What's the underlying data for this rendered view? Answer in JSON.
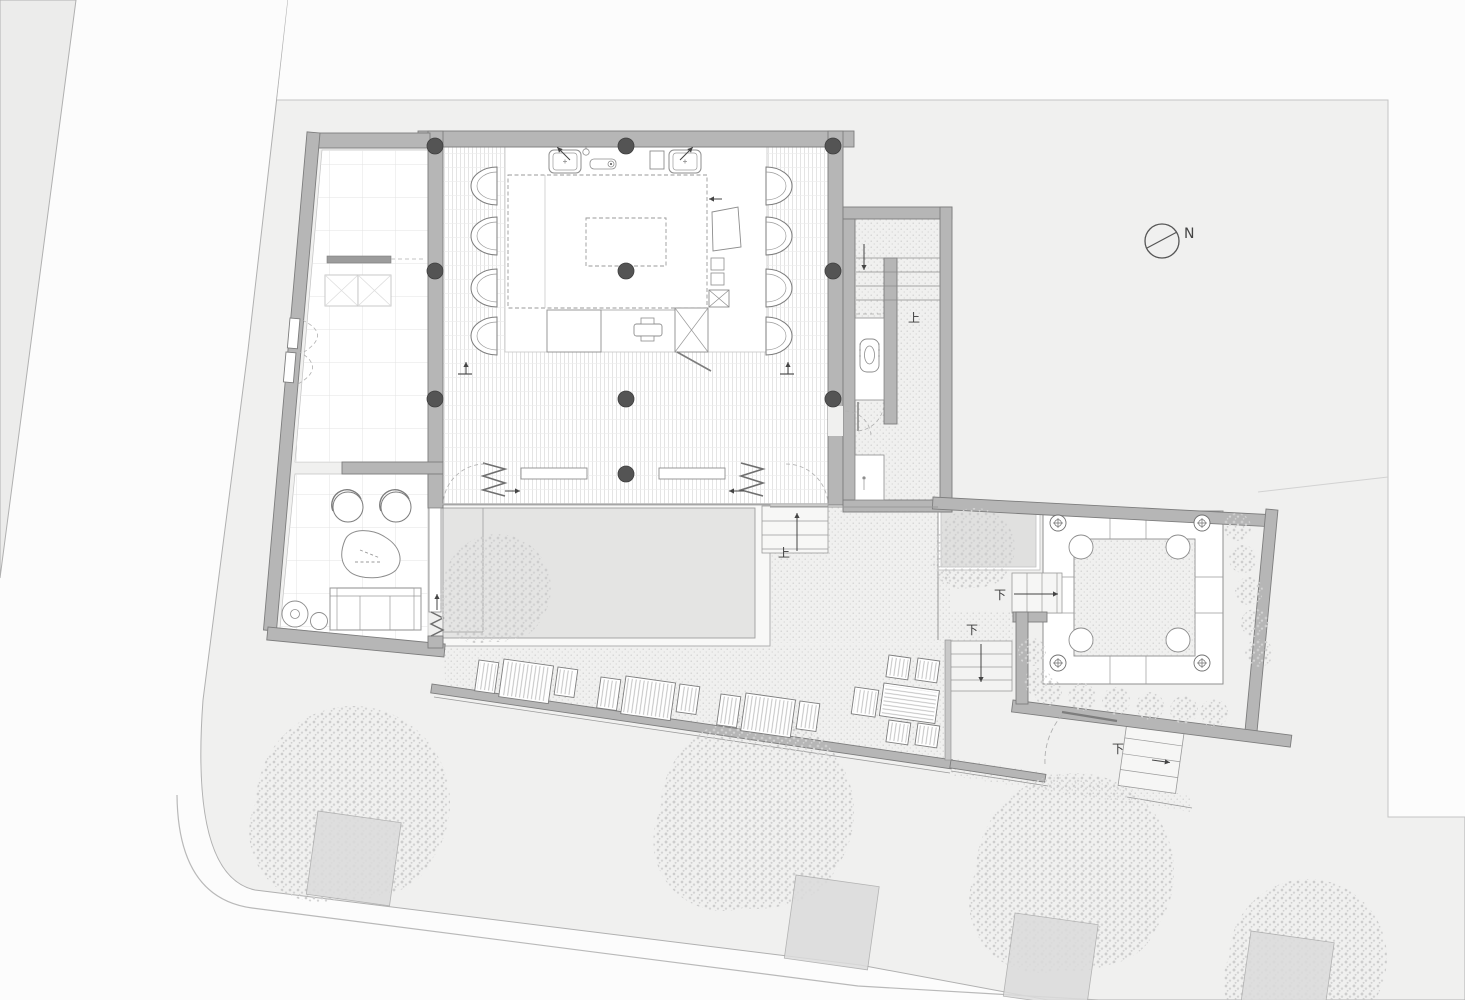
{
  "drawing": {
    "type": "architectural-floor-plan",
    "annotations": {
      "north": "N",
      "up_wing_stair": "上",
      "up_terrace_stair": "上",
      "down_courtyard_steps": "下",
      "down_terrace_stair": "下",
      "down_gate_stair": "下"
    },
    "colors": {
      "paper": "#fcfcfc",
      "site": "#f0f0ef",
      "neighbor": "#ececeb",
      "wall": "#b6b6b6",
      "wall_edge": "#7d7d7d",
      "boundary_line": "#b0b0b0",
      "water": "#e4e4e3",
      "deck": "#f8f8f7",
      "room": "#ffffff",
      "column": "#545454",
      "sand_dot": "#c2c2c2",
      "tree_dot": "#cdcdcd",
      "planter": "#dcdcdc"
    },
    "plan": {
      "columns": [
        [
          435,
          146
        ],
        [
          626,
          146
        ],
        [
          833,
          146
        ],
        [
          435,
          271
        ],
        [
          626,
          271
        ],
        [
          833,
          271
        ],
        [
          435,
          399
        ],
        [
          626,
          399
        ],
        [
          833,
          399
        ],
        [
          626,
          474
        ]
      ],
      "hall_chairs_left": {
        "x": 471,
        "tops": [
          167,
          217,
          269,
          317
        ]
      },
      "hall_chairs_right": {
        "x": 766,
        "tops": [
          167,
          217,
          269,
          317
        ]
      },
      "trees": [
        {
          "x": 497,
          "y": 588,
          "r": 54
        },
        {
          "x": 975,
          "y": 548,
          "r": 40
        },
        {
          "x": 353,
          "y": 803,
          "r": 97
        },
        {
          "x": 757,
          "y": 812,
          "r": 97
        },
        {
          "x": 1075,
          "y": 872,
          "r": 99
        },
        {
          "x": 1308,
          "y": 958,
          "r": 79
        }
      ],
      "bushes": [
        [
          1237,
          527
        ],
        [
          1243,
          559
        ],
        [
          1249,
          591
        ],
        [
          1255,
          623
        ],
        [
          1259,
          653
        ],
        [
          1048,
          692
        ],
        [
          1082,
          697
        ],
        [
          1116,
          701
        ],
        [
          1150,
          706
        ],
        [
          1184,
          710
        ],
        [
          1214,
          713
        ],
        [
          1032,
          652
        ],
        [
          1038,
          682
        ]
      ],
      "planter_beds": [
        {
          "x": 318,
          "y": 811
        },
        {
          "x": 796,
          "y": 875
        },
        {
          "x": 1015,
          "y": 913
        },
        {
          "x": 1251,
          "y": 931
        }
      ],
      "planter_bed_size": 84,
      "planter_bed_rot": 8,
      "round_tables": [
        [
          1081,
          547
        ],
        [
          1178,
          547
        ],
        [
          1081,
          640
        ],
        [
          1178,
          640
        ]
      ],
      "round_table_r": 12,
      "medallions": [
        [
          1058,
          523
        ],
        [
          1202,
          523
        ],
        [
          1058,
          663
        ],
        [
          1202,
          663
        ]
      ],
      "loungers": [
        {
          "x": 479,
          "y": 660,
          "w": 20,
          "h": 31
        },
        {
          "x": 504,
          "y": 659,
          "w": 50,
          "h": 38
        },
        {
          "x": 558,
          "y": 667,
          "w": 20,
          "h": 28
        },
        {
          "x": 601,
          "y": 677,
          "w": 20,
          "h": 31
        },
        {
          "x": 626,
          "y": 676,
          "w": 50,
          "h": 38
        },
        {
          "x": 680,
          "y": 684,
          "w": 20,
          "h": 28
        },
        {
          "x": 721,
          "y": 694,
          "w": 20,
          "h": 31
        },
        {
          "x": 746,
          "y": 693,
          "w": 50,
          "h": 38
        },
        {
          "x": 800,
          "y": 701,
          "w": 20,
          "h": 28
        },
        {
          "x": 889,
          "y": 655,
          "w": 22,
          "h": 22
        },
        {
          "x": 918,
          "y": 658,
          "w": 22,
          "h": 22
        },
        {
          "x": 889,
          "y": 720,
          "w": 22,
          "h": 22
        },
        {
          "x": 918,
          "y": 723,
          "w": 22,
          "h": 22
        },
        {
          "x": 855,
          "y": 687,
          "w": 24,
          "h": 27
        },
        {
          "x": 884,
          "y": 683,
          "w": 56,
          "h": 33,
          "horiz": true
        }
      ],
      "lounger_rot": 8,
      "swivel_chairs": [
        [
          348,
          507
        ],
        [
          396,
          507
        ]
      ],
      "side_tables": [
        {
          "x": 295,
          "y": 614,
          "r": 13,
          "inner": 4.5
        },
        {
          "x": 319,
          "y": 621,
          "r": 8.5
        }
      ],
      "arrows": [
        {
          "x": 505,
          "y": 491,
          "len": 15,
          "rot": 0
        },
        {
          "x": 744,
          "y": 491,
          "len": 15,
          "rot": 180
        },
        {
          "x": 437,
          "y": 610,
          "len": 16,
          "rot": -90
        },
        {
          "x": 864,
          "y": 244,
          "len": 26,
          "rot": 90
        },
        {
          "x": 1014,
          "y": 594,
          "len": 44,
          "rot": 0
        },
        {
          "x": 981,
          "y": 644,
          "len": 38,
          "rot": 90
        },
        {
          "x": 1152,
          "y": 760,
          "len": 18,
          "rot": 8
        },
        {
          "x": 722,
          "y": 199,
          "len": 13,
          "rot": 180
        },
        {
          "x": 466,
          "y": 374,
          "len": 12,
          "rot": -90
        },
        {
          "x": 788,
          "y": 374,
          "len": 12,
          "rot": -90
        },
        {
          "x": 570,
          "y": 160,
          "len": 18,
          "rot": -135
        },
        {
          "x": 680,
          "y": 160,
          "len": 18,
          "rot": -45
        },
        {
          "x": 797,
          "y": 551,
          "len": 38,
          "rot": -90
        }
      ]
    }
  }
}
